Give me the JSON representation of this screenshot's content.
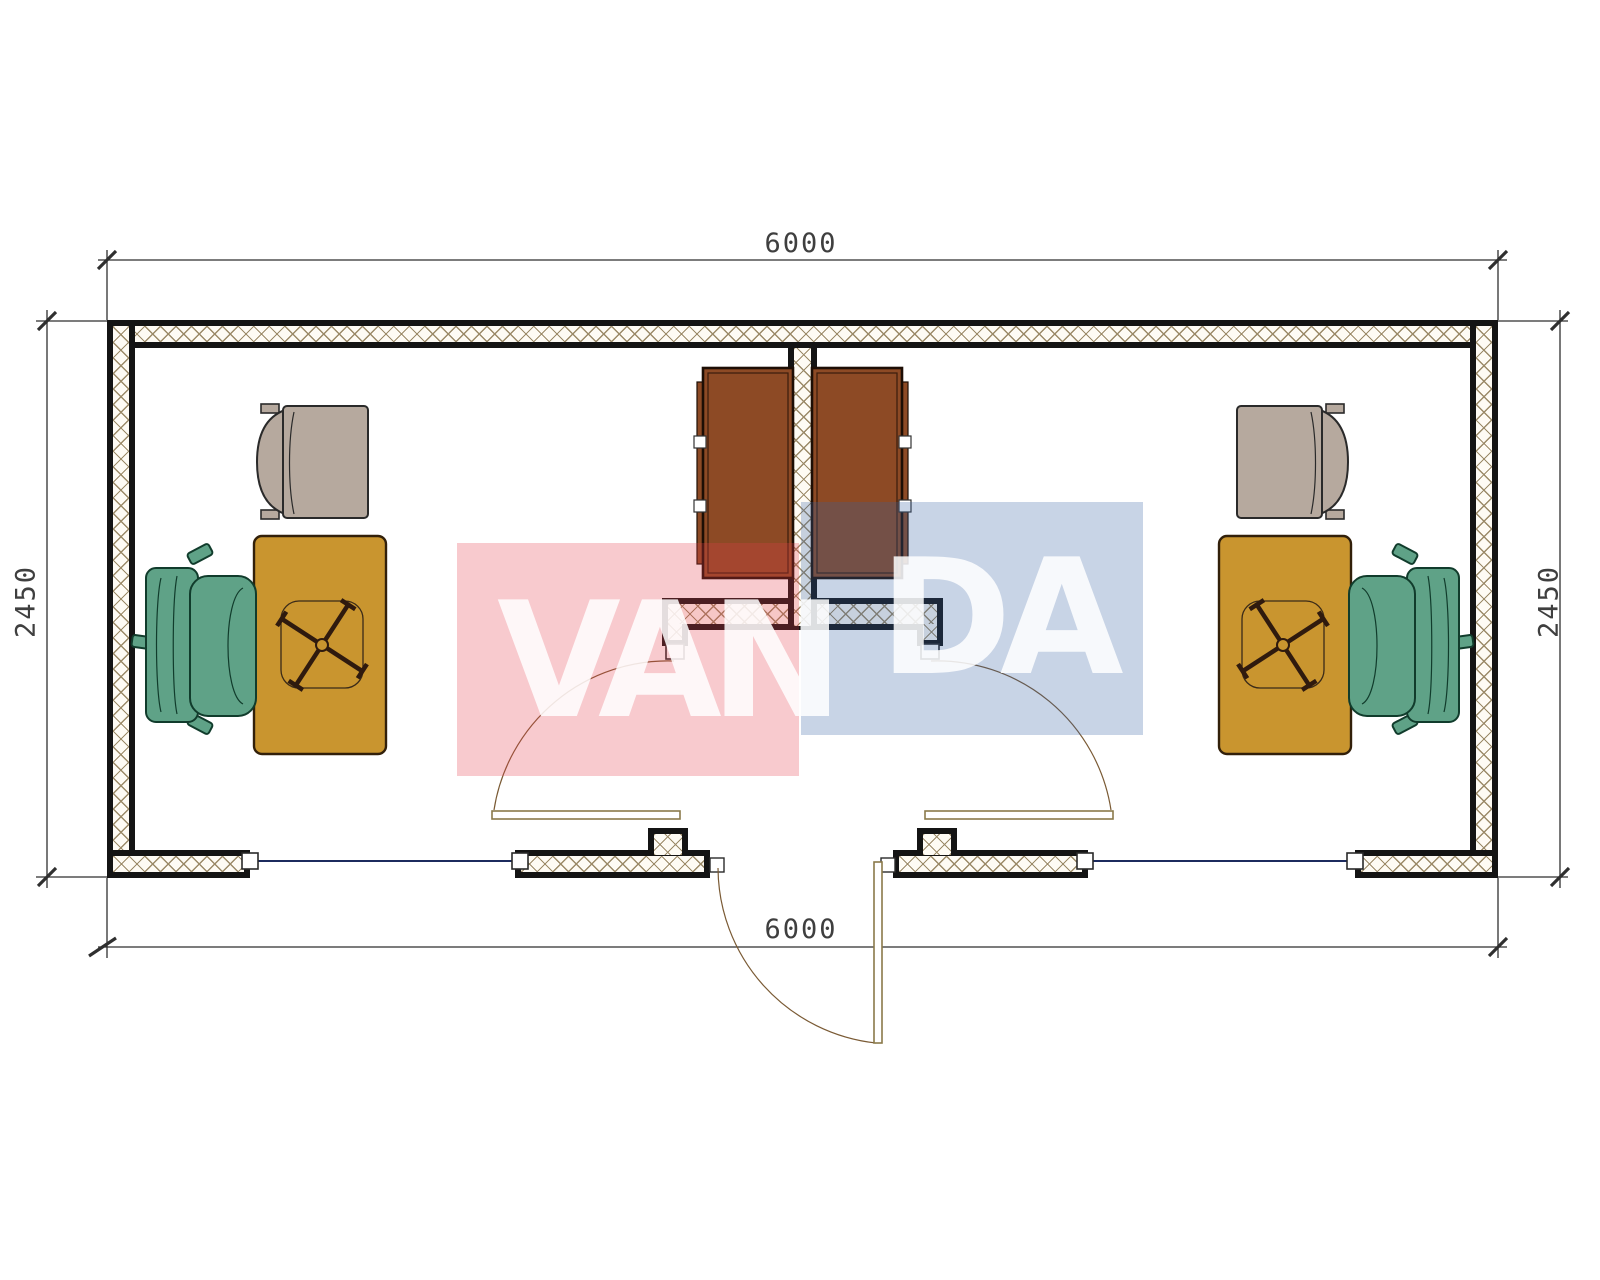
{
  "dimensions": {
    "top": "6000",
    "bottom": "6000",
    "left": "2450",
    "right": "2450"
  },
  "watermark": {
    "text": "VANDA",
    "left_part": "VAN",
    "right_part": "DA"
  },
  "colors": {
    "wall_line": "#141414",
    "hatch_line": "#9b8a68",
    "hatch_bg": "#fefbf4",
    "desk": "#c9952f",
    "desk_line": "#32200a",
    "chair": "#5fa287",
    "chair_line": "#113c2c",
    "armchair": "#b6a99e",
    "armchair_line": "#2a2a2a",
    "cabinet": "#8d4a25",
    "cabinet_line": "#1d0e05",
    "window_line": "#1c2b5e",
    "door_line": "#8a7a4a",
    "arc_line": "#7a5a34",
    "dim_line": "#2f2f2f",
    "dim_text": "#3f3f3f",
    "wm_red": "rgba(230,60,75,0.27)",
    "wm_blue": "rgba(51,95,163,0.27)",
    "wm_text": "rgba(255,255,255,0.85)",
    "cross_line": "#2f1a0e"
  }
}
